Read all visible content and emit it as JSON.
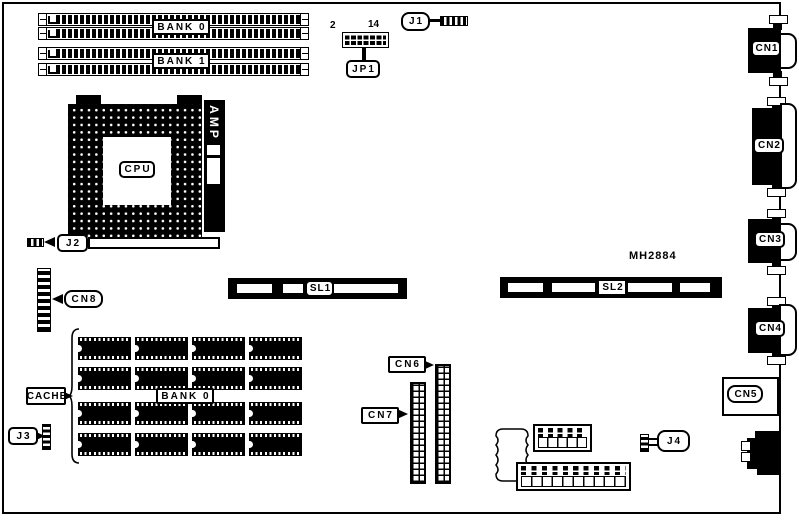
{
  "board": {
    "memory": {
      "bank0_label": "BANK 0",
      "bank1_label": "BANK 1"
    },
    "cpu_label": "CPU",
    "amp_label": "AMP",
    "part_number": "MH2884",
    "jumpers": {
      "jp1": "JP1",
      "jp1_first_pin": "2",
      "jp1_last_pin": "14",
      "j1": "J1",
      "j2": "J2",
      "j3": "J3",
      "j4": "J4"
    },
    "slots": {
      "sl1": "SL1",
      "sl2": "SL2"
    },
    "cache": {
      "label": "CACHE",
      "bank_label": "BANK 0"
    },
    "connectors": {
      "cn1": "CN1",
      "cn2": "CN2",
      "cn3": "CN3",
      "cn4": "CN4",
      "cn5": "CN5",
      "cn6": "CN6",
      "cn7": "CN7",
      "cn8": "CN8"
    },
    "colors": {
      "ink": "#000000",
      "paper": "#ffffff"
    }
  }
}
